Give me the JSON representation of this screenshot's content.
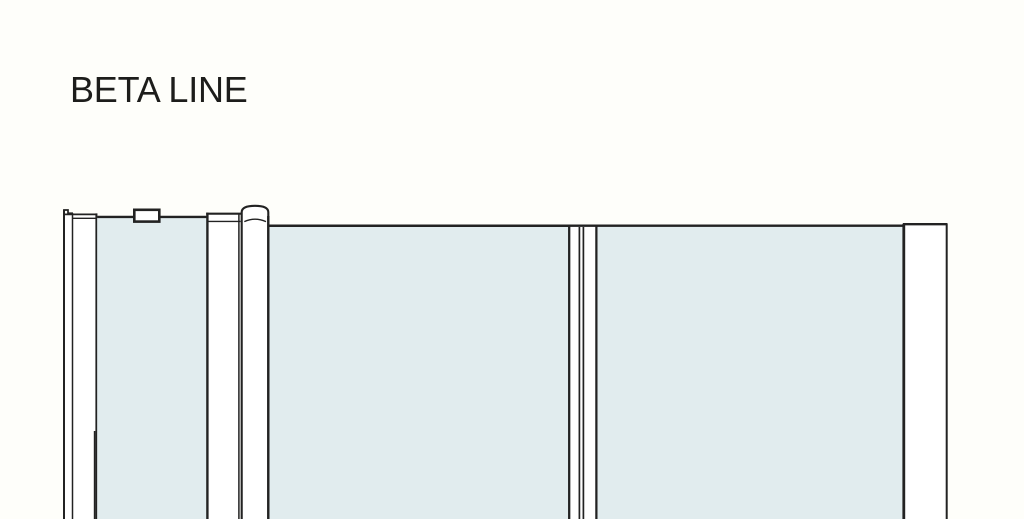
{
  "title": {
    "text": "BETA LINE"
  },
  "colors": {
    "background": "#FEFEFA",
    "line": "#222222",
    "glass_fill": "#E1ECEE",
    "profile_fill": "#FFFFFF",
    "title": "#1D1D1B"
  },
  "diagram": {
    "kind": "technical-elevation-drawing",
    "parts": [
      "wall-profile-left",
      "glass-panel-side",
      "clamp-bracket",
      "hinge-profile",
      "pivot-profile-round",
      "glass-panel-door",
      "seal-joint",
      "glass-panel-fixed",
      "wall-profile-right"
    ]
  }
}
